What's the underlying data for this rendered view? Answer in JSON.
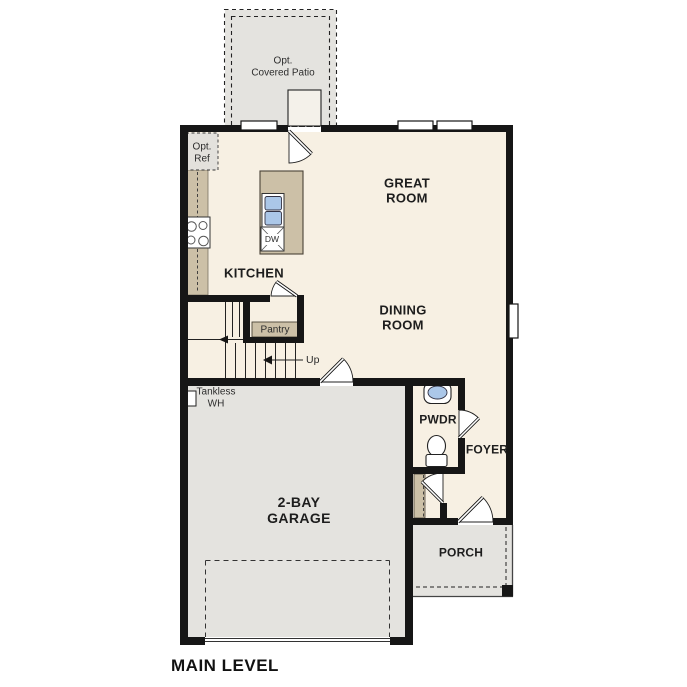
{
  "plan": {
    "title": "MAIN LEVEL",
    "rooms": {
      "great_room": {
        "lines": [
          "GREAT",
          "ROOM"
        ]
      },
      "dining_room": {
        "lines": [
          "DINING",
          "ROOM"
        ]
      },
      "kitchen": {
        "label": "KITCHEN"
      },
      "garage": {
        "lines": [
          "2-BAY",
          "GARAGE"
        ]
      },
      "pwdr": {
        "label": "PWDR"
      },
      "foyer": {
        "label": "FOYER"
      },
      "porch": {
        "label": "PORCH"
      },
      "pantry": {
        "label": "Pantry"
      }
    },
    "annotations": {
      "covered_patio": {
        "lines": [
          "Opt.",
          "Covered Patio"
        ]
      },
      "opt_ref": {
        "lines": [
          "Opt.",
          "Ref"
        ]
      },
      "tankless_wh": {
        "lines": [
          "Tankless",
          "WH"
        ]
      },
      "up": {
        "label": "Up"
      },
      "dishwasher": {
        "label": "DW"
      }
    },
    "colors": {
      "wall": "#161616",
      "floor": "#f7f0e3",
      "concrete": "#e4e3df",
      "casework": "#ccc0a7",
      "fixture_blue": "#abc7e8"
    }
  }
}
